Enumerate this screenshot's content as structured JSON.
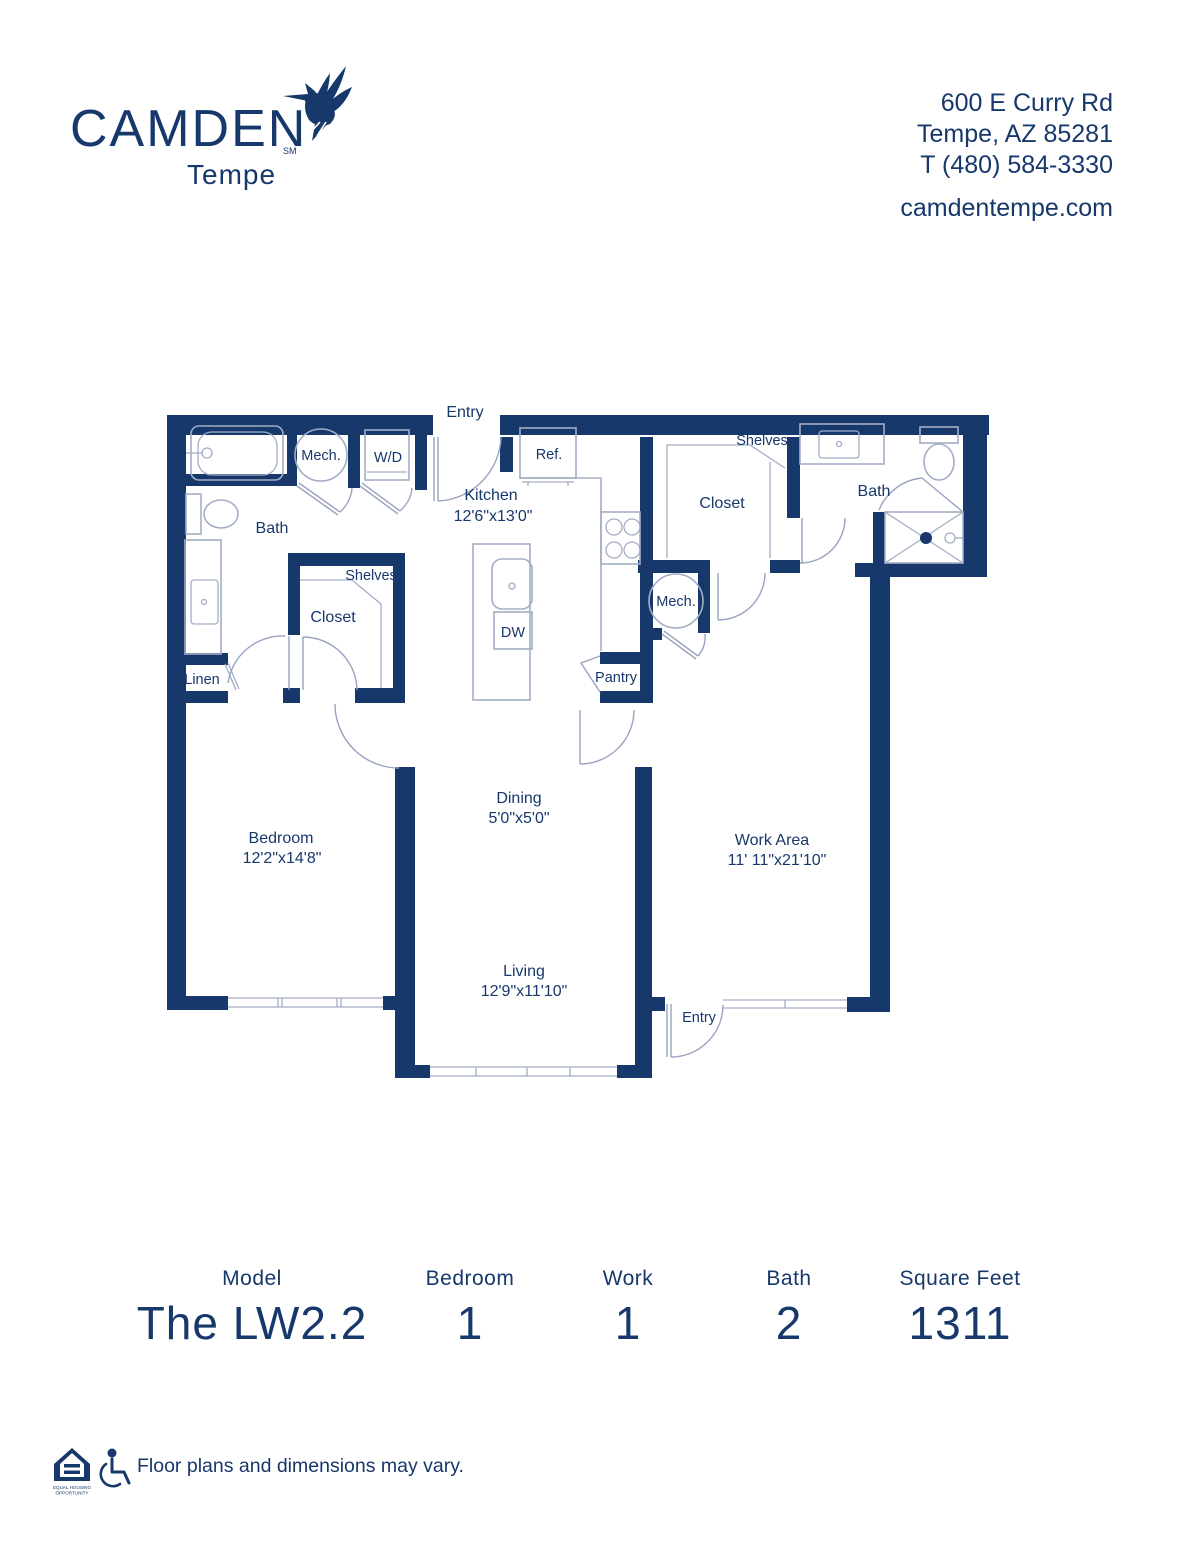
{
  "header": {
    "brand": "CAMDEN",
    "brand_mark": "SM",
    "community": "Tempe",
    "address_line1": "600 E Curry Rd",
    "address_line2": "Tempe, AZ 85281",
    "address_line3": "T (480) 584-3330",
    "website": "camdentempe.com"
  },
  "floorplan": {
    "labels": {
      "entry_top": "Entry",
      "entry_work": "Entry",
      "mech_a": "Mech.",
      "mech_b": "Mech.",
      "wd": "W/D",
      "ref": "Ref.",
      "dw": "DW",
      "pantry": "Pantry",
      "linen": "Linen",
      "shelves_a": "Shelves",
      "shelves_b": "Shelves",
      "closet_a": "Closet",
      "closet_b": "Closet",
      "bath_a": "Bath",
      "bath_b": "Bath",
      "kitchen": "Kitchen",
      "kitchen_dims": "12'6\"x13'0\"",
      "dining": "Dining",
      "dining_dims": "5'0\"x5'0\"",
      "bedroom": "Bedroom",
      "bedroom_dims": "12'2\"x14'8\"",
      "work_area": "Work Area",
      "work_area_dims": "11' 11\"x21'10\"",
      "living": "Living",
      "living_dims": "12'9\"x11'10\"",
      "entry_bottom": "Entry"
    }
  },
  "summary": {
    "columns": [
      {
        "label": "Model",
        "value": "The LW2.2"
      },
      {
        "label": "Bedroom",
        "value": "1"
      },
      {
        "label": "Work",
        "value": "1"
      },
      {
        "label": "Bath",
        "value": "2"
      },
      {
        "label": "Square Feet",
        "value": "1311"
      }
    ]
  },
  "footer": {
    "disclaimer": "Floor plans and dimensions may vary.",
    "eho_line1": "EQUAL HOUSING",
    "eho_line2": "OPPORTUNITY"
  },
  "colors": {
    "navy": "#17386b",
    "line": "#a4adc6"
  }
}
